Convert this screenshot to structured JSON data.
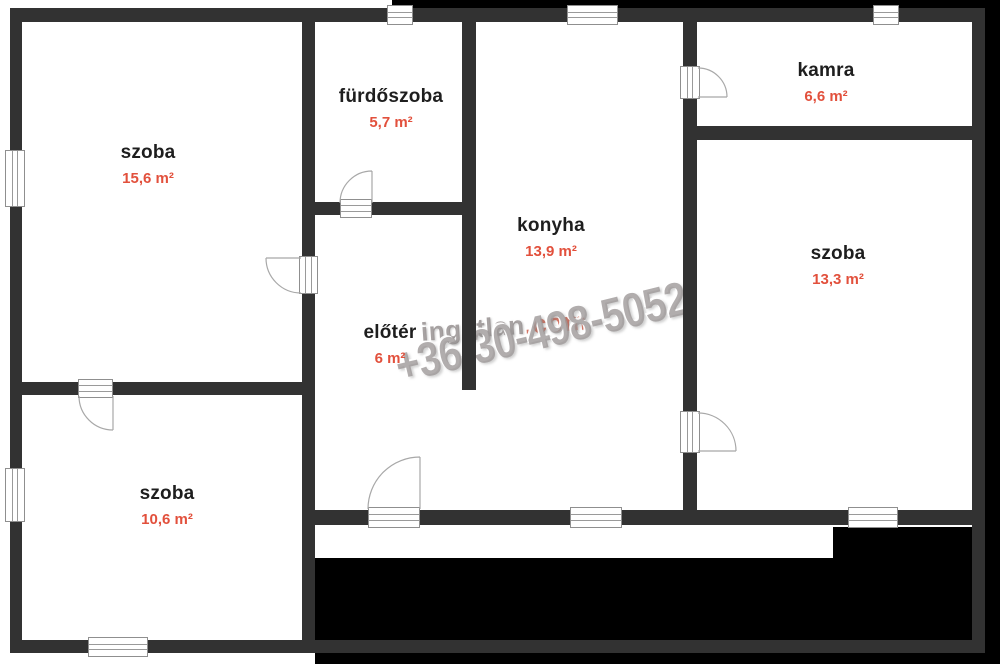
{
  "plan_title": "apartment floor plan",
  "rooms": [
    {
      "name": "szoba",
      "area": "15,6 m²"
    },
    {
      "name": "fürdőszoba",
      "area": "5,7 m²"
    },
    {
      "name": "konyha",
      "area": "13,9 m²"
    },
    {
      "name": "kamra",
      "area": "6,6 m²"
    },
    {
      "name": "szoba",
      "area": "13,3 m²"
    },
    {
      "name": "előtér",
      "area": "6 m²"
    },
    {
      "name": "szoba",
      "area": "10,6 m²"
    }
  ],
  "watermark": {
    "brand_gray": "ingatlan",
    "brand_red": ".com",
    "phone": "+36-30-498-5052"
  },
  "colors": {
    "wall": "#323232",
    "floor": "#ffffff",
    "background": "#000000",
    "room_name_text": "#1e1e1e",
    "room_area_text": "#e2503c",
    "watermark_gray": "#948e8e",
    "watermark_red": "#cb5c48"
  }
}
